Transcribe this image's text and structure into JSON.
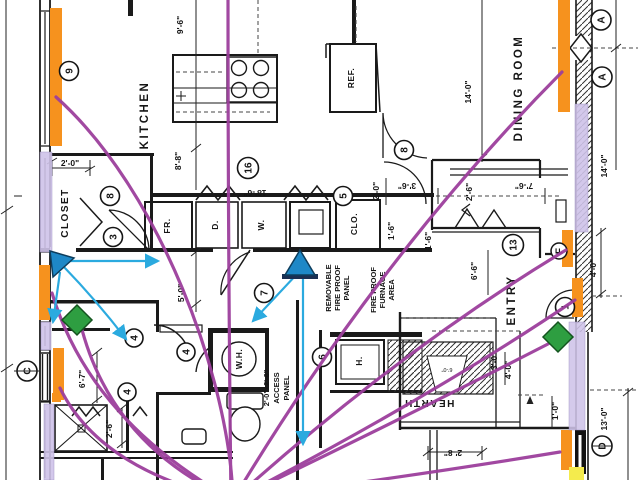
{
  "title": "floor-plan-annotated",
  "colors": {
    "thread_purple": "#9C3F9C",
    "arrow_cyan": "#2BAADF",
    "highlight_orange": "#F6921E",
    "highlight_lavender": "#CFC3E9",
    "highlight_yellow": "#F4EB4D",
    "diamond_green": "#2E9E41",
    "triangle_blue": "#1E88C7",
    "linework": "#1a1a1a"
  },
  "rooms": {
    "kitchen": "KITCHEN",
    "dining": "DINING ROOM",
    "entry": "ENTRY",
    "closet": "CLOSET",
    "hearth": "HEARTH"
  },
  "fixtures": {
    "ref": "REF.",
    "fr": "FR.",
    "dryer": "D.",
    "washer": "W.",
    "clo": "CLO.",
    "water_heater": "W.H.",
    "heater": "H."
  },
  "notes": {
    "removable": [
      "REMOVABLE",
      "FIRE PROOF",
      "PANEL"
    ],
    "furnace": [
      "FIRE PROOF",
      "FURNACE",
      "AREA"
    ],
    "access": [
      "2'-0\"x2'-6\"",
      "ACCESS",
      "PANEL"
    ]
  },
  "dims": {
    "d96": "9'-6\"",
    "d88": "8'-8\"",
    "d186": "18'-6\"",
    "d20a": "2'-0\"",
    "d20b": "2'-0\"",
    "d50": "5'-0\"",
    "d140a": "14'-0\"",
    "d140b": "14'-0\"",
    "d76": "7'-6\"",
    "d26a": "2'-6\"",
    "d36": "3'-6\"",
    "d16a": "1'-6\"",
    "d16b": "1'-6\"",
    "d66": "6'-6\"",
    "d40a": "4'-0\"",
    "d40b": "4'-0\"",
    "d67": "6'-7\"",
    "d26b": "2'-6\"",
    "d30": "3'-0\"",
    "d10": "1'-0\"",
    "d28": "2'-8\"",
    "d130": "13'-0\"",
    "d60": "6'-0\""
  },
  "markers": {
    "m9": "9",
    "m8a": "8",
    "m8b": "8",
    "m3": "3",
    "m16": "16",
    "m5": "5",
    "m7": "7",
    "m6": "6",
    "m13": "13",
    "m4a": "4",
    "m4b": "4",
    "m4c": "4",
    "mF": "F",
    "m1": "1",
    "mA1": "A",
    "mA2": "A",
    "mC": "C",
    "mD": "D"
  }
}
